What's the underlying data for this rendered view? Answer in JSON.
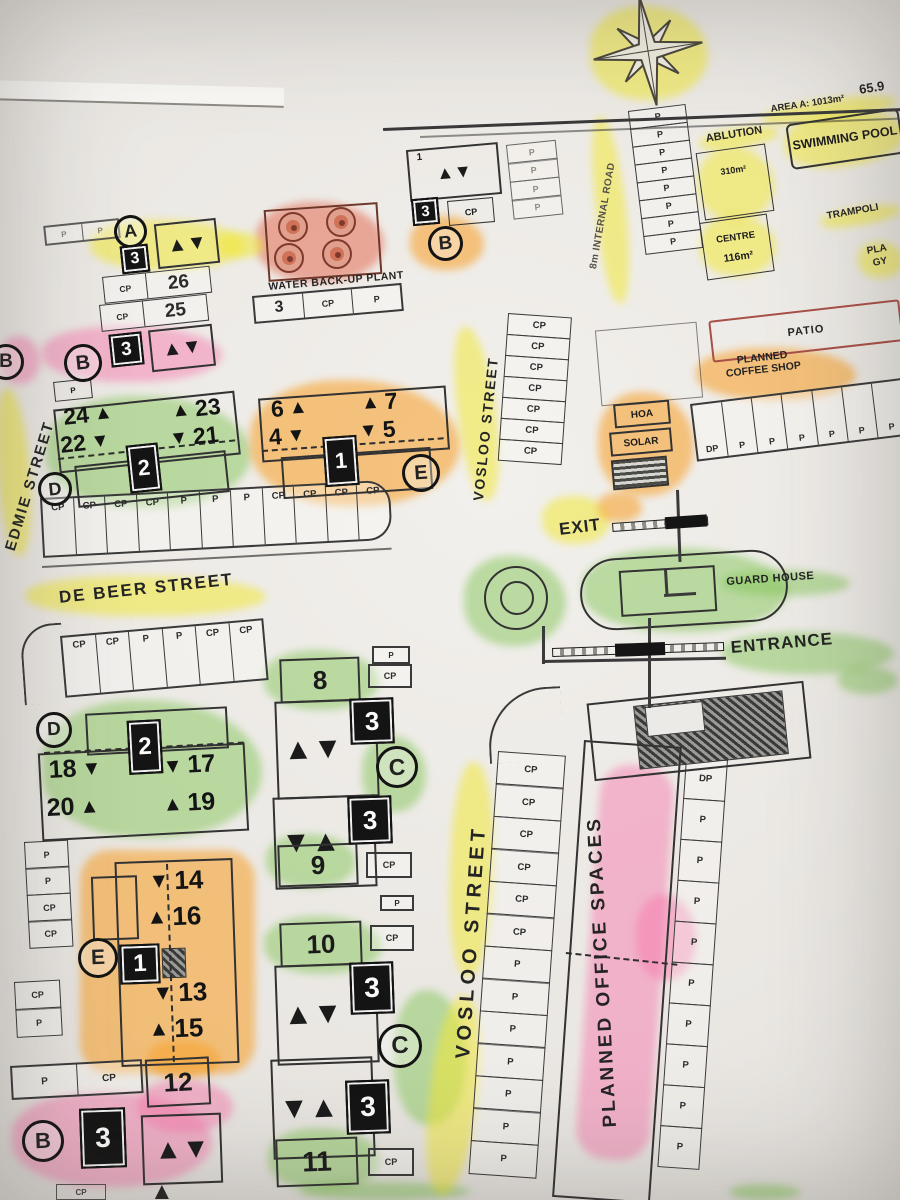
{
  "glyphs": {
    "up": "▲",
    "down": "▼",
    "updown": "▲▼",
    "downup": "▼▲"
  },
  "cells": {
    "p": "P",
    "cp": "CP"
  },
  "streets": {
    "edmie": "EDMIE STREET",
    "de_beer": "DE BEER STREET",
    "vosloo_upper": "VOSLOO STREET",
    "vosloo_lower": "VOSLOO STREET",
    "internal_road": "8m INTERNAL ROAD"
  },
  "site": {
    "exit": "EXIT",
    "entrance": "ENTRANCE",
    "guard_house": "GUARD HOUSE",
    "water_plant": "WATER BACK-UP PLANT",
    "swimming_pool": "SWIMMING POOL",
    "ablution": "ABLUTION",
    "ablution_area": "310m²",
    "centre": "CENTRE",
    "centre_area": "116m²",
    "trampoline": "TRAMPOLI",
    "play_line1": "PLA",
    "play_line2": "GY",
    "patio": "PATIO",
    "coffee_line1": "PLANNED",
    "coffee_line2": "COFFEE SHOP",
    "hoa": "HOA",
    "solar": "SOLAR",
    "planned_office": "PLANNED OFFICE SPACES",
    "area_a": "AREA A: 1013m²",
    "boundary_dim": "65.9"
  },
  "blocks": {
    "a": {
      "letter": "A",
      "count": "3",
      "row1_p": "CP",
      "row1_unit": "26",
      "row2_p": "CP",
      "row2_unit": "25"
    },
    "top_mid": {
      "unit": "1",
      "count": "3",
      "cp": "CP",
      "letter": "B"
    },
    "header_row": {
      "c1": "3",
      "c2": "CP",
      "c3": "P"
    },
    "b_edge": {
      "letter": "B"
    },
    "b_mid": {
      "letter": "B",
      "count": "3"
    },
    "d1": {
      "letter": "D",
      "stand": "2",
      "tl": "24",
      "bl": "22",
      "tr": "23",
      "br": "21"
    },
    "e1": {
      "letter": "E",
      "stand": "1",
      "tl": "6",
      "bl": "4",
      "tr": "7",
      "br": "5"
    },
    "d2": {
      "letter": "D",
      "stand": "2",
      "tl": "18",
      "bl": "20",
      "tr": "17",
      "br": "19"
    },
    "e2": {
      "letter": "E",
      "stand": "1",
      "r1": "14",
      "r2": "16",
      "r3": "13",
      "r4": "15"
    },
    "unit12": "12",
    "b_bottom": {
      "letter": "B",
      "count": "3"
    },
    "m1": {
      "top": "8",
      "letter": "C",
      "count1": "3",
      "count2": "3",
      "bottom": "9"
    },
    "m2": {
      "top": "10",
      "letter": "C",
      "count1": "3",
      "count2": "3",
      "bottom": "11"
    }
  },
  "parking": {
    "top_left": [
      "P",
      "P"
    ],
    "internal_road_col": [
      "P",
      "P",
      "P",
      "P",
      "P",
      "P",
      "P",
      "P"
    ],
    "top_mid_col": [
      "P",
      "P",
      "P",
      "P"
    ],
    "coffee_row": [
      "DP",
      "P",
      "P",
      "P",
      "P",
      "P",
      "P"
    ],
    "vosloo_cp_col": [
      "CP",
      "CP",
      "CP",
      "CP",
      "CP",
      "CP",
      "CP"
    ],
    "de_beer_row": [
      "CP",
      "CP",
      "CP",
      "CP",
      "P",
      "P",
      "P",
      "CP",
      "CP",
      "CP",
      "CP"
    ],
    "lower_left_row": [
      "CP",
      "CP",
      "P",
      "P",
      "CP",
      "CP"
    ],
    "left_col_a": [
      "P",
      "P",
      "CP",
      "CP"
    ],
    "left_col_b": [
      "CP",
      "P"
    ],
    "bottom_left_row": [
      "P",
      "CP"
    ],
    "m1_right_top": [
      "P"
    ],
    "m1_right_mid": [
      "CP"
    ],
    "m1_right_bottom": [
      "CP"
    ],
    "m2_right_top": [
      "P"
    ],
    "m2_right_mid": [
      "CP"
    ],
    "m2_right_bottom": [
      "CP"
    ],
    "office_left_col": [
      "CP",
      "CP",
      "CP",
      "CP",
      "CP",
      "CP",
      "P",
      "P",
      "P",
      "P",
      "P",
      "P",
      "P"
    ],
    "office_right_col": [
      "DP",
      "P",
      "P",
      "P",
      "P",
      "P",
      "P",
      "P",
      "P",
      "P"
    ]
  }
}
